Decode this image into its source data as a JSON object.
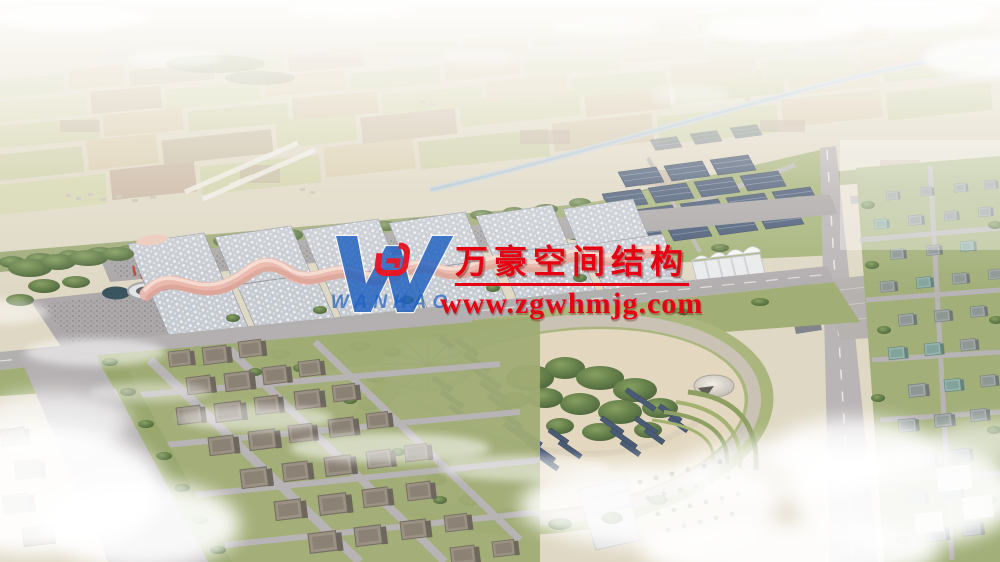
{
  "watermark": {
    "title": "万豪空间结构",
    "url": "www.zgwhmjg.com",
    "logo_word": "WANHAO"
  },
  "palette": {
    "wm-red": "#e60012",
    "wm-blue": "#1d5fc0",
    "canopy-pink": "#e9b4a8",
    "panel-navy": "#3f516f"
  }
}
